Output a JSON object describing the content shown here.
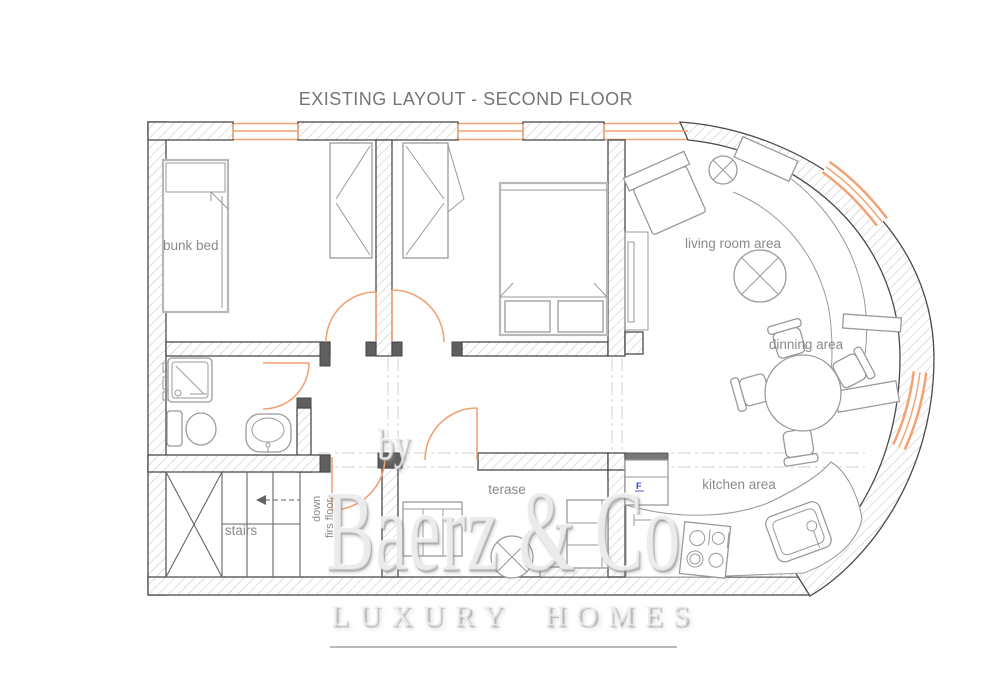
{
  "title": "EXISTING LAYOUT - SECOND FLOOR",
  "labels": {
    "bunk_bed": "bunk bed",
    "living_room": "living room area",
    "dining": "dinning area",
    "kitchen": "kitchen area",
    "terrace": "terase",
    "stairs": "stairs",
    "stairs_direction_line1": "down",
    "stairs_direction_line2": "firs floor",
    "fridge_marker": "F"
  },
  "watermark": {
    "prefix": "by",
    "brand": "Baerz & Co",
    "tagline": "LUXURY HOMES"
  },
  "colors": {
    "wall_outline": "#4a4a4a",
    "hatch": "#c6c6c6",
    "furniture": "#9a9a9a",
    "furniture_light": "#b8b8b8",
    "doors_windows": "#F2A273",
    "label_text": "#8a8a8a",
    "title_text": "#757575",
    "watermark_text": "#dedede",
    "fridge_marker_color": "#3a46d8",
    "reference_line": "#d2d2d2"
  }
}
